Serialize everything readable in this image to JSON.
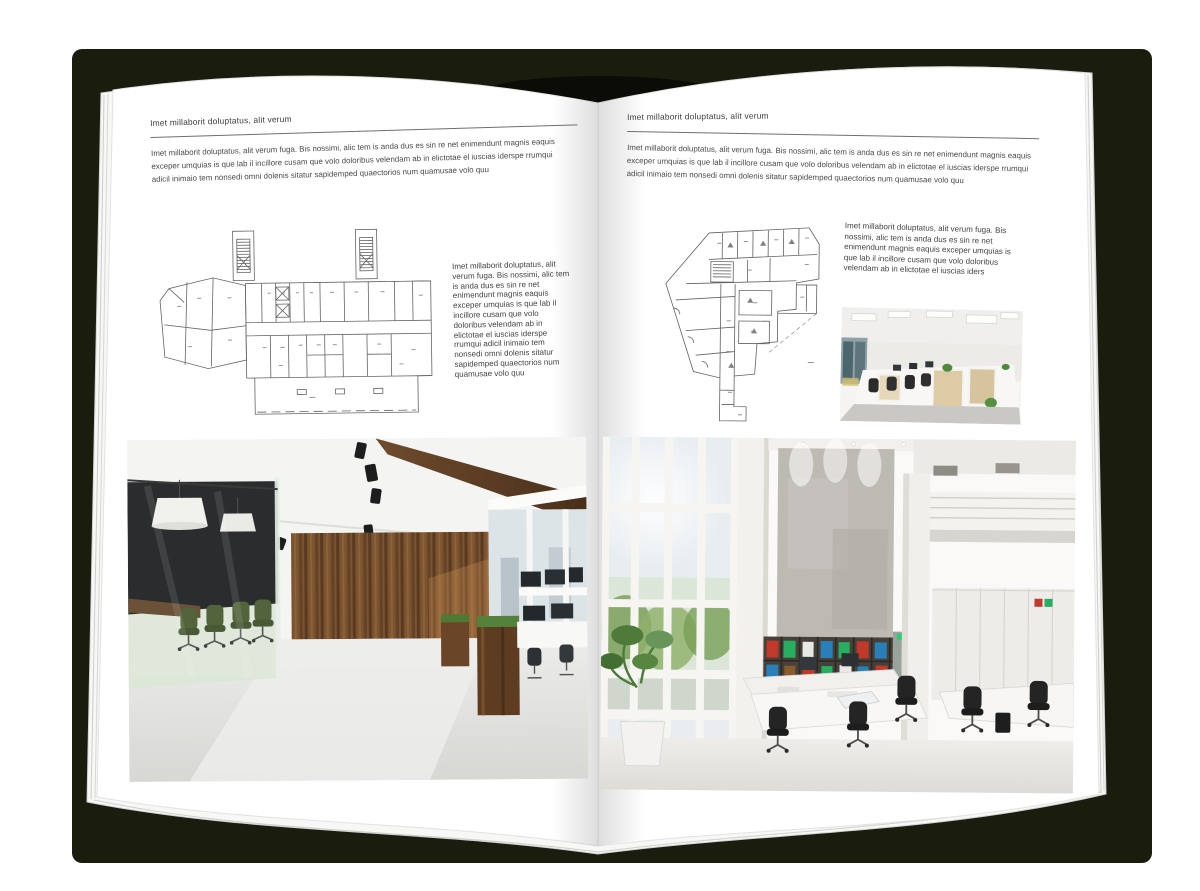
{
  "book": {
    "backdrop_color": "#1a1c0e",
    "page_color": "#ffffff"
  },
  "left_page": {
    "header": "Imet millaborit doluptatus, alit verum",
    "intro_paragraph": "Imet millaborit doluptatus, alit verum fuga. Bis nossimi, alic tem is anda dus es sin re net enimendunt magnis eaquis exceper umquias is que lab il incillore cusam que volo doloribus velendam ab in elictotae el iuscias iderspe rrumqui adicil inimaio tem nonsedi omni dolenis sitatur sapidemped quaectorios num quamusae volo quu",
    "side_paragraph": "Imet millaborit doluptatus, alit verum fuga. Bis nossimi, alic tem is anda dus es sin re net enimendunt magnis eaquis exceper umquias is que lab il incillore cusam que volo doloribus velendam ab in elictotae el iuscias iderspe rrumqui adicil inimaio tem nonsedi omni dolenis sitatur sapidemped quaectorios num quamusae volo quu"
  },
  "right_page": {
    "header": "Imet millaborit doluptatus, alit verum",
    "intro_paragraph": "Imet millaborit doluptatus, alit verum fuga. Bis nossimi, alic tem is anda dus es sin re net enimendunt magnis eaquis exceper umquias is que lab il incillore cusam que volo doloribus velendam ab in elictotae el iuscias iderspe rrumqui adicil inimaio tem nonsedi omni dolenis sitatur sapidemped quaectorios num quamusae volo quu",
    "side_paragraph": "Imet millaborit doluptatus, alit verum fuga. Bis nossimi, alic tem is anda dus es sin re net enimendunt magnis eaquis exceper umquias is que lab il incillore cusam que volo doloribus velendam ab in elictotae el iuscias iders"
  },
  "photos": {
    "left_photo_alt": "modern office with wood wall, glass meeting room and green chairs",
    "right_photo_alt": "bright double-height office with tall windows, concrete wall and bookshelf",
    "small_photo_alt": "open-plan office with white cubicle desks"
  },
  "colors": {
    "wood": "#6e4a2a",
    "chair_green": "#48592f",
    "concrete": "#bcb9b3",
    "plant_green": "#57873e"
  }
}
